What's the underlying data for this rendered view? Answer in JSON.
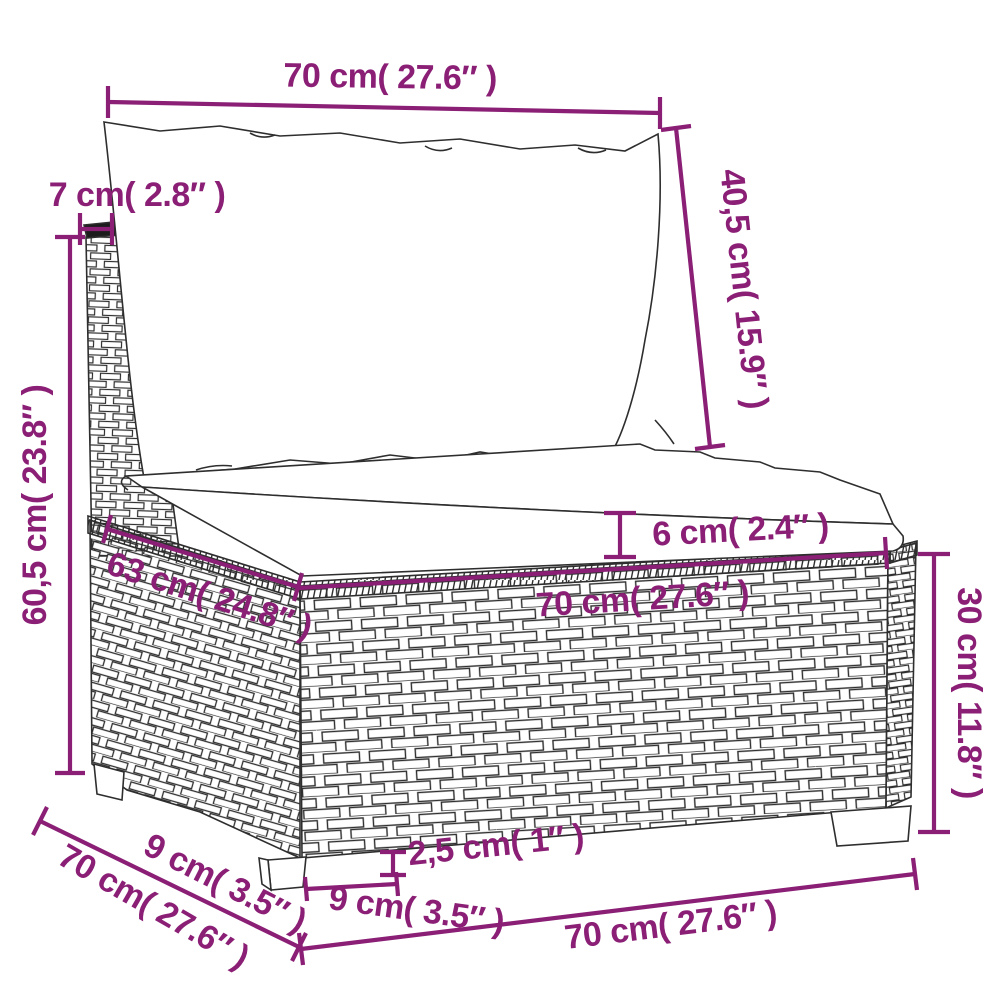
{
  "diagram": {
    "type": "product-dimension-diagram",
    "subject": "poly-rattan modular garden sofa middle section with back cushion and seat cushion",
    "units": {
      "primary": "cm",
      "secondary": "inches"
    },
    "colors": {
      "dimension": "#8A1F75",
      "line_art": "#2e2e2e",
      "background": "#ffffff",
      "braid_cap": "#1c1c1c"
    }
  },
  "annotations": {
    "back_cushion_width": {
      "text": "70 cm( 27.6″ )",
      "value_cm": 70,
      "value_in": 27.6
    },
    "back_frame_thickness": {
      "text": "7 cm( 2.8″ )",
      "value_cm": 7,
      "value_in": 2.8
    },
    "back_cushion_height": {
      "text": "40,5 cm( 15.9″ )",
      "value_cm": 40.5,
      "value_in": 15.9
    },
    "total_height": {
      "text": "60,5 cm( 23.8″ )",
      "value_cm": 60.5,
      "value_in": 23.8
    },
    "seat_top_depth": {
      "text": "63 cm( 24.8″ )",
      "value_cm": 63,
      "value_in": 24.8
    },
    "seat_cushion_thickness": {
      "text": "6 cm( 2.4″ )",
      "value_cm": 6,
      "value_in": 2.4
    },
    "seat_width": {
      "text": "70 cm( 27.6″ )",
      "value_cm": 70,
      "value_in": 27.6
    },
    "base_height": {
      "text": "30 cm( 11.8″ )",
      "value_cm": 30,
      "value_in": 11.8
    },
    "leg_inset_depth": {
      "text": "9 cm( 3.5″ )",
      "value_cm": 9,
      "value_in": 3.5
    },
    "overall_depth": {
      "text": "70 cm( 27.6″ )",
      "value_cm": 70,
      "value_in": 27.6
    },
    "leg_height": {
      "text": "2,5 cm( 1″ )",
      "value_cm": 2.5,
      "value_in": 1
    },
    "leg_width": {
      "text": "9 cm( 3.5″ )",
      "value_cm": 9,
      "value_in": 3.5
    },
    "overall_width": {
      "text": "70 cm( 27.6″ )",
      "value_cm": 70,
      "value_in": 27.6
    }
  }
}
